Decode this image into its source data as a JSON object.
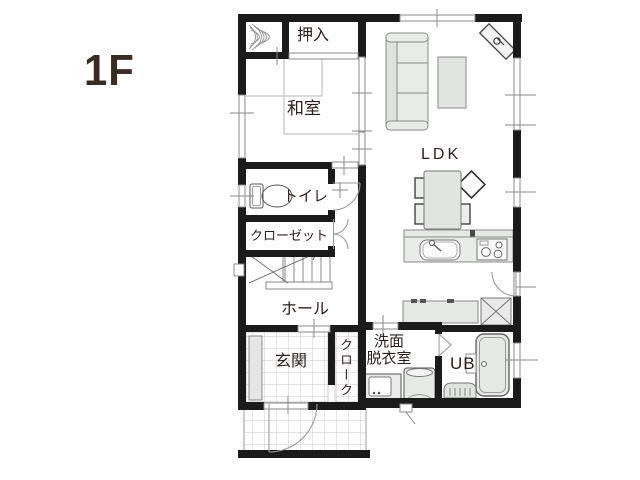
{
  "floor_label": "1F",
  "rooms": {
    "oshiire": {
      "label": "押入"
    },
    "washitsu": {
      "label": "和室"
    },
    "ldk": {
      "label": "LDK"
    },
    "toilet": {
      "label": "トイレ"
    },
    "closet": {
      "label": "クローゼット"
    },
    "hall": {
      "label": "ホール"
    },
    "genkan": {
      "label": "玄関"
    },
    "cloak": {
      "label": "クローク"
    },
    "washroom": {
      "label_line1": "洗面",
      "label_line2": "脱衣室"
    },
    "bath": {
      "label": "UB"
    }
  },
  "fixtures": {
    "sofa": "sofa",
    "coffee_table": "coffee-table",
    "tv_board": "tv-on-corner-board",
    "dining_table": "dining-table-with-chairs",
    "kitchen_sink": "kitchen-sink",
    "gas_stove": "gas-stove",
    "cupboard": "kitchen-cupboard",
    "refrigerator": "refrigerator-space",
    "toilet_bowl": "toilet-bowl",
    "staircase": "staircase-up",
    "shoe_cabinet": "shoe-cabinet",
    "washing_machine": "washing-machine",
    "vanity": "vanity-basin",
    "bathtub": "bathtub",
    "tokonoma": "tokonoma-alcove"
  },
  "colors": {
    "wall": "#1b1b1b",
    "line": "#8a8a8a",
    "furniture_fill": "#e7e9e7",
    "tile_line": "#c9c9c9",
    "text": "#28211f",
    "floor_label_color": "#382c29"
  }
}
